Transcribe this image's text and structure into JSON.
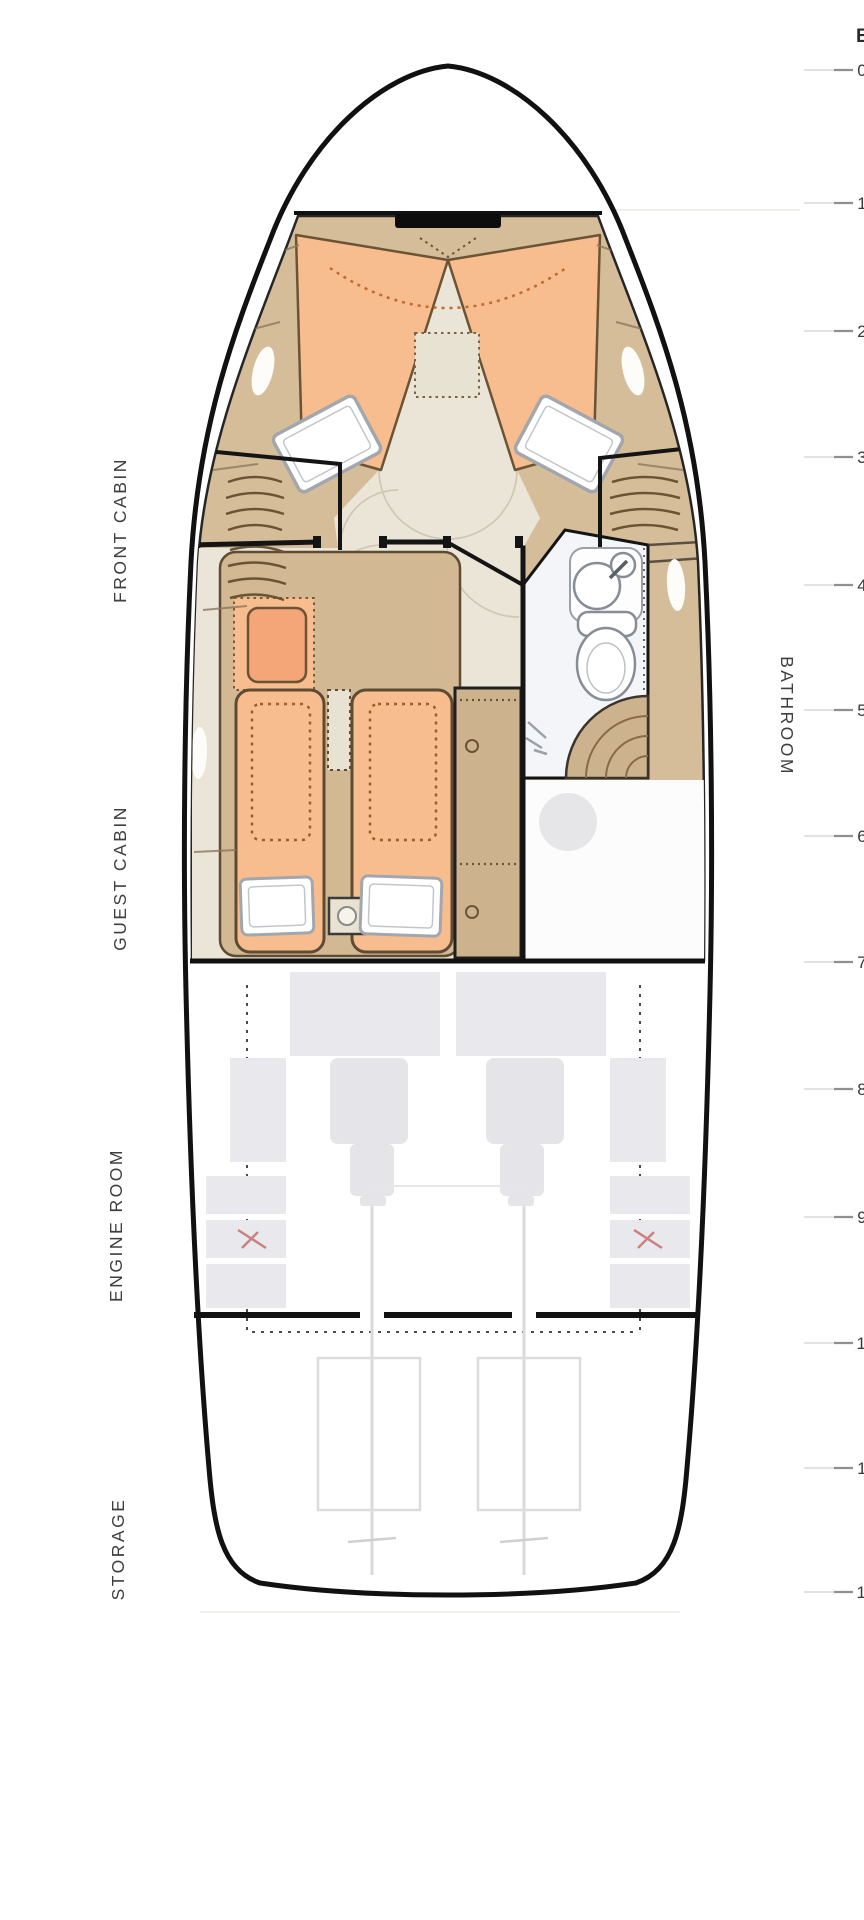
{
  "plan": {
    "type": "yacht-deck-floorplan",
    "rooms": [
      {
        "id": "front-cabin",
        "label": "FRONT CABIN"
      },
      {
        "id": "guest-cabin",
        "label": "GUEST CABIN"
      },
      {
        "id": "engine-room",
        "label": "ENGINE ROOM"
      },
      {
        "id": "storage",
        "label": "STORAGE"
      },
      {
        "id": "bathroom",
        "label": "BATHROOM"
      }
    ],
    "colors": {
      "hull_outline": "#111111",
      "wood": "#d6bd9a",
      "wood_dark": "#cdb38d",
      "mattress_orange": "#f8bd8e",
      "seat_orange": "#f4a678",
      "floor_cream": "#eae5d6",
      "bathroom_floor": "#f3f5f8",
      "equipment_gray": "#e9e9ed",
      "accent_red": "#c4716f",
      "label_gray": "#3f3f3f"
    }
  },
  "ruler": {
    "unit": "E",
    "ticks": [
      "0",
      "1",
      "2",
      "3",
      "4",
      "5",
      "6",
      "7",
      "8",
      "9",
      "10",
      "11",
      "12"
    ]
  }
}
